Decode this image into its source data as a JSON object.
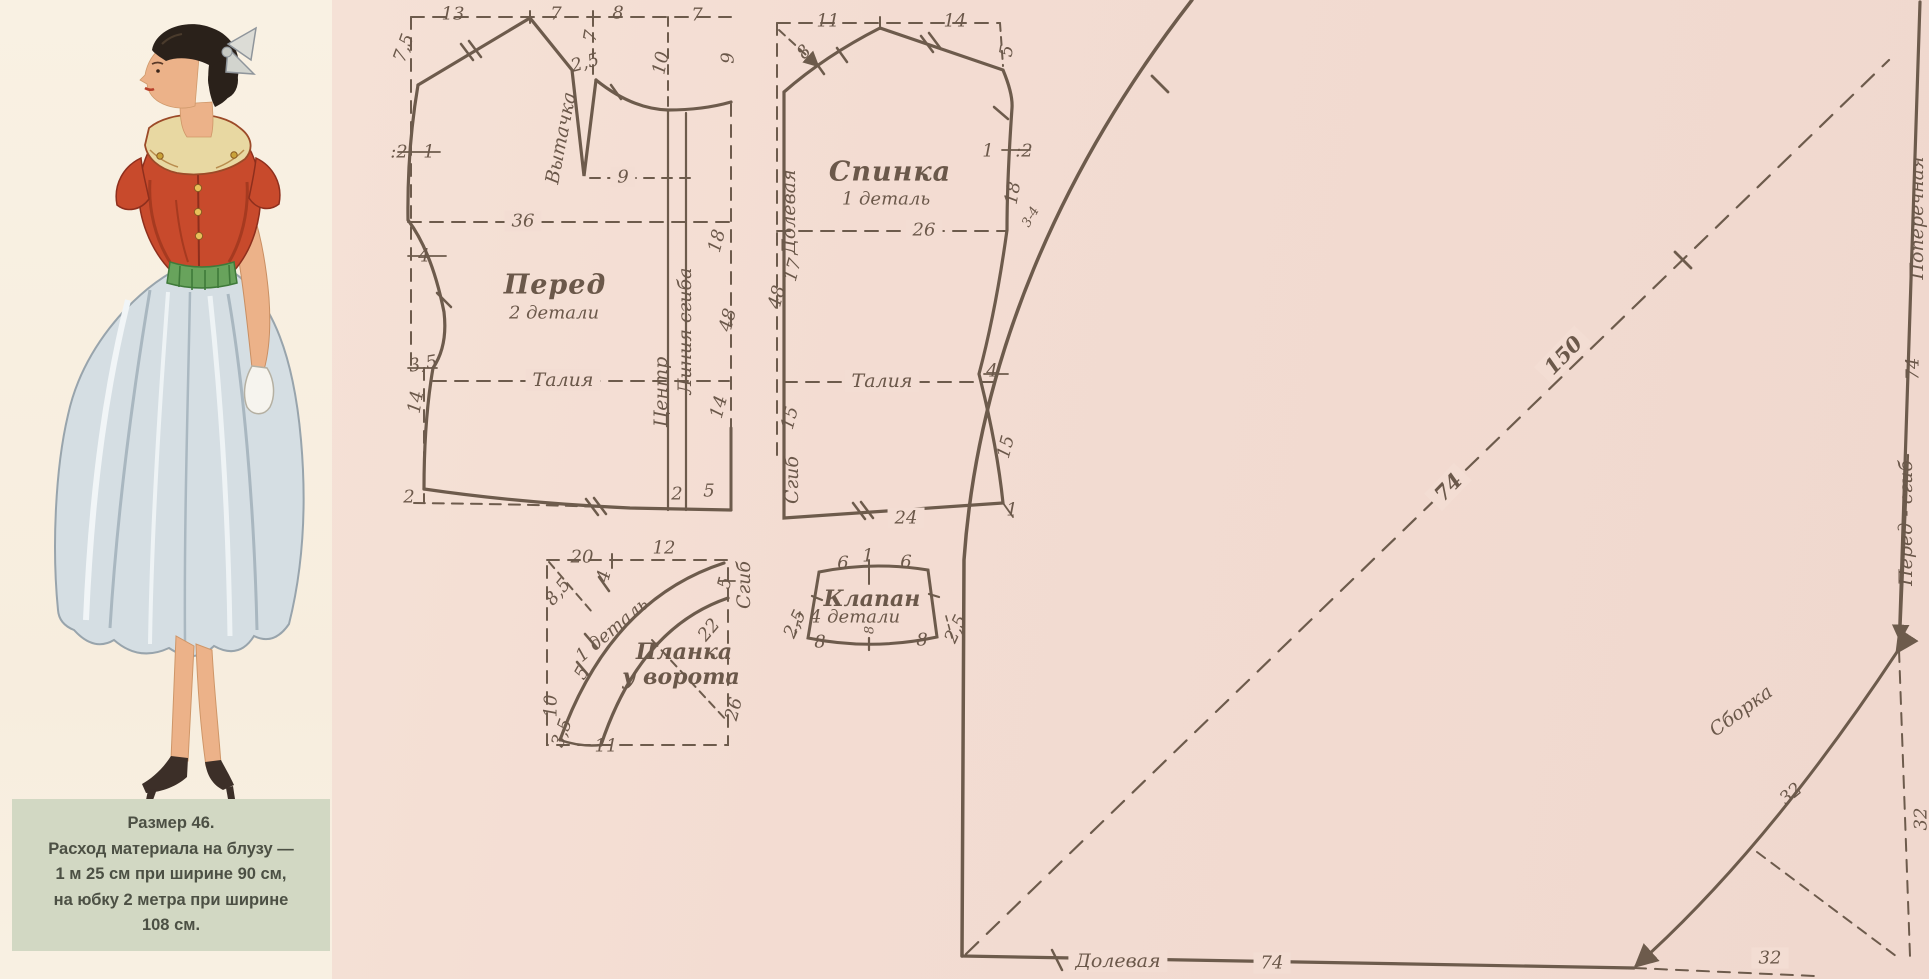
{
  "page_title": "Выкройка. Размер 46",
  "caption": {
    "lines": [
      "Размер 46.",
      "Расход материала на блузу —",
      "1 м 25 см при ширине 90 см,",
      "на юбку  2 метра при ширине",
      "108 см."
    ]
  },
  "pieces": {
    "front": {
      "name": "Перед",
      "count": "2 детали"
    },
    "back": {
      "name": "Спинка",
      "count": "1 деталь"
    },
    "placket": {
      "name": "Планка у ворота",
      "count": "1 деталь"
    },
    "flap": {
      "name": "Клапан",
      "count": "4 детали"
    },
    "skirt": {
      "grain": "Долевая",
      "cross": "Поперечная",
      "fold": "Перед - сгиб",
      "gather": "Сборка"
    }
  },
  "colors": {
    "paper_pink": "#f3dcd2",
    "panel_cream": "#f8efe1",
    "caption_bg": "#d2d8c3",
    "line_ink": "#6d5b4c",
    "label_ink": "#6b584a",
    "blouse_red": "#c84a2c",
    "collar_cream": "#e8d8a2",
    "belt_green": "#68a35c",
    "skirt_blue": "#d4dde3",
    "hair_dark": "#2a211a",
    "skin": "#ecb289"
  },
  "labels": [
    {
      "t": "13",
      "x": 453,
      "y": 14
    },
    {
      "t": "7",
      "x": 556,
      "y": 14
    },
    {
      "t": "8",
      "x": 618,
      "y": 13
    },
    {
      "t": "7",
      "x": 697,
      "y": 15
    },
    {
      "t": "7",
      "x": 591,
      "y": 36,
      "r": -80
    },
    {
      "t": "7,5",
      "x": 404,
      "y": 48,
      "r": -70
    },
    {
      "t": "10",
      "x": 661,
      "y": 63,
      "r": -78
    },
    {
      "t": "2,5",
      "x": 585,
      "y": 63,
      "r": -15
    },
    {
      "t": "Вытачка",
      "x": 561,
      "y": 138,
      "r": -79,
      "cls": "word",
      "n": "dart-label"
    },
    {
      "t": "9",
      "x": 623,
      "y": 177,
      "bg": true
    },
    {
      "t": "9",
      "x": 728,
      "y": 58,
      "r": -90
    },
    {
      "t": ":2",
      "x": 399,
      "y": 152
    },
    {
      "t": "1",
      "x": 429,
      "y": 152
    },
    {
      "t": "36",
      "x": 523,
      "y": 221,
      "bg": true
    },
    {
      "t": "4",
      "x": 424,
      "y": 256
    },
    {
      "t": "Перед",
      "x": 555,
      "y": 285,
      "cls": "name",
      "n": "piece-name-front"
    },
    {
      "t": "2 детали",
      "x": 554,
      "y": 313,
      "cls": "sub",
      "n": "piece-count-front"
    },
    {
      "t": "Талия",
      "x": 563,
      "y": 380,
      "bg": true,
      "cls": "word",
      "n": "waist-line-front"
    },
    {
      "t": "3,5",
      "x": 423,
      "y": 364,
      "r": -10
    },
    {
      "t": "14",
      "x": 416,
      "y": 402,
      "r": -80
    },
    {
      "t": "2",
      "x": 409,
      "y": 497
    },
    {
      "t": "Центр",
      "x": 661,
      "y": 392,
      "r": -90,
      "cls": "word",
      "n": "center-line-label"
    },
    {
      "t": "Линия сгиба",
      "x": 685,
      "y": 331,
      "r": -90,
      "cls": "word",
      "n": "fold-line-label"
    },
    {
      "t": "2",
      "x": 677,
      "y": 494
    },
    {
      "t": "5",
      "x": 709,
      "y": 491
    },
    {
      "t": "18",
      "x": 717,
      "y": 241,
      "r": -75
    },
    {
      "t": "48",
      "x": 728,
      "y": 320,
      "r": -75
    },
    {
      "t": "14",
      "x": 719,
      "y": 407,
      "r": -75
    },
    {
      "t": "11",
      "x": 828,
      "y": 21
    },
    {
      "t": "14",
      "x": 955,
      "y": 21
    },
    {
      "t": "8",
      "x": 804,
      "y": 52,
      "r": -45
    },
    {
      "t": "5",
      "x": 1007,
      "y": 51,
      "r": -80
    },
    {
      "t": "1",
      "x": 988,
      "y": 151
    },
    {
      "t": ":2",
      "x": 1024,
      "y": 151
    },
    {
      "t": "18",
      "x": 1013,
      "y": 193,
      "r": -80
    },
    {
      "t": "3-4",
      "x": 1031,
      "y": 217,
      "r": -60,
      "cls": "small"
    },
    {
      "t": "Спинка",
      "x": 890,
      "y": 172,
      "cls": "name",
      "n": "piece-name-back"
    },
    {
      "t": "1 деталь",
      "x": 886,
      "y": 199,
      "cls": "sub",
      "n": "piece-count-back"
    },
    {
      "t": "26",
      "x": 924,
      "y": 230,
      "bg": true
    },
    {
      "t": "Долевая",
      "x": 789,
      "y": 212,
      "r": -90,
      "cls": "word",
      "n": "grain-line-back"
    },
    {
      "t": "17",
      "x": 793,
      "y": 270,
      "r": -75
    },
    {
      "t": "48",
      "x": 777,
      "y": 297,
      "r": -75
    },
    {
      "t": "Талия",
      "x": 882,
      "y": 381,
      "bg": true,
      "cls": "word",
      "n": "waist-line-back"
    },
    {
      "t": "4",
      "x": 992,
      "y": 371
    },
    {
      "t": "15",
      "x": 790,
      "y": 418,
      "r": -75
    },
    {
      "t": "15",
      "x": 1006,
      "y": 447,
      "r": -75
    },
    {
      "t": "Сгиб",
      "x": 792,
      "y": 480,
      "r": -90,
      "cls": "word",
      "n": "fold-edge-back"
    },
    {
      "t": "24",
      "x": 906,
      "y": 518,
      "bg": true
    },
    {
      "t": "1",
      "x": 1012,
      "y": 510
    },
    {
      "t": "20",
      "x": 582,
      "y": 557
    },
    {
      "t": "12",
      "x": 664,
      "y": 548
    },
    {
      "t": "8,5",
      "x": 558,
      "y": 592,
      "r": -50
    },
    {
      "t": "4",
      "x": 604,
      "y": 576,
      "r": -75
    },
    {
      "t": "5",
      "x": 725,
      "y": 583,
      "r": -75
    },
    {
      "t": "Сгиб",
      "x": 744,
      "y": 585,
      "r": -90,
      "cls": "word",
      "n": "fold-edge-placket"
    },
    {
      "t": "1 деталь",
      "x": 612,
      "y": 630,
      "r": -40,
      "cls": "sub",
      "n": "piece-count-placket"
    },
    {
      "t": "Планка",
      "x": 684,
      "y": 652,
      "cls": "name2",
      "n": "piece-name-placket-1"
    },
    {
      "t": "у ворота",
      "x": 681,
      "y": 677,
      "cls": "name2",
      "n": "piece-name-placket-2"
    },
    {
      "t": "22",
      "x": 709,
      "y": 630,
      "r": -50
    },
    {
      "t": "26",
      "x": 734,
      "y": 709,
      "r": -75
    },
    {
      "t": "5",
      "x": 582,
      "y": 673,
      "r": -60
    },
    {
      "t": "10",
      "x": 551,
      "y": 706,
      "r": -90
    },
    {
      "t": "3,5",
      "x": 562,
      "y": 733,
      "r": -70
    },
    {
      "t": "11",
      "x": 606,
      "y": 746
    },
    {
      "t": "6",
      "x": 843,
      "y": 563
    },
    {
      "t": "1",
      "x": 868,
      "y": 556
    },
    {
      "t": "6",
      "x": 906,
      "y": 562
    },
    {
      "t": "Клапан",
      "x": 872,
      "y": 599,
      "cls": "name2",
      "n": "piece-name-flap"
    },
    {
      "t": "4 детали",
      "x": 855,
      "y": 617,
      "cls": "sub",
      "n": "piece-count-flap"
    },
    {
      "t": "8",
      "x": 870,
      "y": 630,
      "r": -90,
      "cls": "small"
    },
    {
      "t": "2,5",
      "x": 795,
      "y": 624,
      "r": -65
    },
    {
      "t": "8",
      "x": 820,
      "y": 642
    },
    {
      "t": "8",
      "x": 922,
      "y": 640
    },
    {
      "t": "2,5",
      "x": 956,
      "y": 629,
      "r": -65
    },
    {
      "t": "150",
      "x": 1563,
      "y": 355,
      "r": -46,
      "cls": "big",
      "bg": true
    },
    {
      "t": "74",
      "x": 1448,
      "y": 487,
      "r": -46,
      "cls": "big",
      "bg": true
    },
    {
      "t": "Поперечная",
      "x": 1917,
      "y": 218,
      "r": -90,
      "cls": "word",
      "n": "cross-grain-skirt"
    },
    {
      "t": "74",
      "x": 1913,
      "y": 369,
      "r": -90
    },
    {
      "t": "Перед - сгиб",
      "x": 1906,
      "y": 523,
      "r": -90,
      "cls": "word",
      "n": "front-fold-skirt"
    },
    {
      "t": "Сборка",
      "x": 1741,
      "y": 711,
      "r": -36,
      "cls": "word",
      "n": "gather-label"
    },
    {
      "t": "32",
      "x": 1791,
      "y": 794,
      "r": -40
    },
    {
      "t": "32",
      "x": 1921,
      "y": 819,
      "r": -90
    },
    {
      "t": "32",
      "x": 1770,
      "y": 958,
      "bg": true
    },
    {
      "t": "74",
      "x": 1272,
      "y": 963,
      "bg": true
    },
    {
      "t": "Долевая",
      "x": 1118,
      "y": 961,
      "bg": true,
      "cls": "word",
      "n": "grain-line-skirt"
    }
  ]
}
